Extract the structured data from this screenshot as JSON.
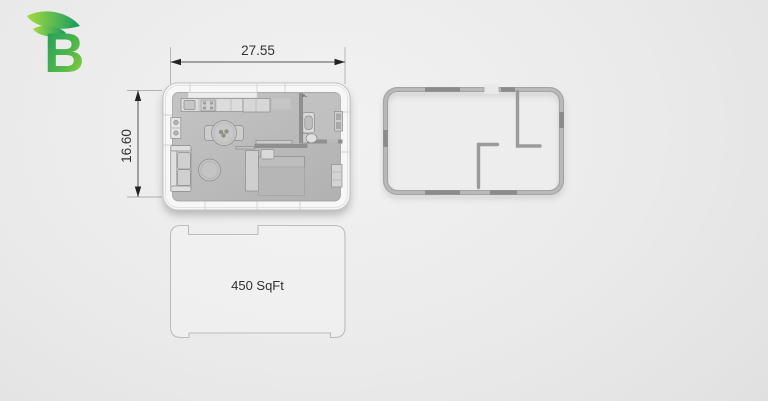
{
  "logo": {
    "letter": "B",
    "teal": "#149a61",
    "lime": "#a2d83c"
  },
  "dimensions": {
    "width_label": "27.55",
    "height_label": "16.60"
  },
  "footprint": {
    "area_label": "450 SqFt"
  },
  "plans": {
    "furnished": {
      "name": "furnished-floor-plan",
      "furniture": [
        "kitchen-counter",
        "sink",
        "stove",
        "fridge-cabinet",
        "tall-cabinet",
        "dining-table",
        "dining-chair",
        "coffee-table",
        "sofa",
        "bed",
        "pillow",
        "divider-wall",
        "bathroom",
        "vanity",
        "toilet",
        "bath-shelf",
        "dresser",
        "entry-mat"
      ]
    },
    "empty": {
      "name": "empty-wall-plan",
      "features": [
        "outer-wall-tube",
        "door-opening",
        "bathroom-partition-wall",
        "bedroom-partition-wall"
      ]
    }
  },
  "colors": {
    "background": "#e8e8e8",
    "plan_floor": "#bcbcbc",
    "wall_white": "#f7f7f7",
    "wall_dark": "#8f8f8f",
    "tube_wall": "#a6a6a6",
    "dimension_line": "#555555",
    "extension_line": "#b0b0b0",
    "text": "#333333"
  }
}
